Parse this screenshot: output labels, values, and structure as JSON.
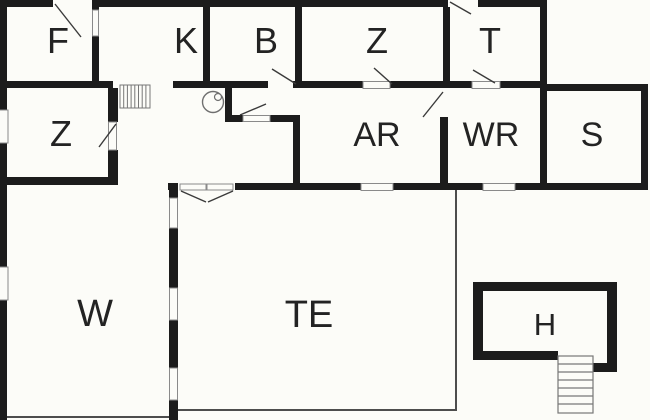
{
  "page": {
    "title": "Floor plan"
  },
  "rooms": {
    "f": {
      "label": "F"
    },
    "k": {
      "label": "K"
    },
    "b": {
      "label": "B"
    },
    "z_top": {
      "label": "Z"
    },
    "t": {
      "label": "T"
    },
    "z_left": {
      "label": "Z"
    },
    "ar": {
      "label": "AR"
    },
    "wr": {
      "label": "WR"
    },
    "s": {
      "label": "S"
    },
    "w": {
      "label": "W"
    },
    "te": {
      "label": "TE"
    },
    "h": {
      "label": "H"
    }
  },
  "icons": {
    "hall_stairs": "staircase-icon",
    "h_stairs": "staircase-icon",
    "fixture": "round-fixture-icon"
  },
  "colors": {
    "background": "#fcfcf8",
    "wall": "#1c1c1c",
    "thin_line": "#4d4d4d",
    "window_stroke": "#8a8a8a",
    "door_line": "#3a3a3a",
    "label": "#232323"
  }
}
